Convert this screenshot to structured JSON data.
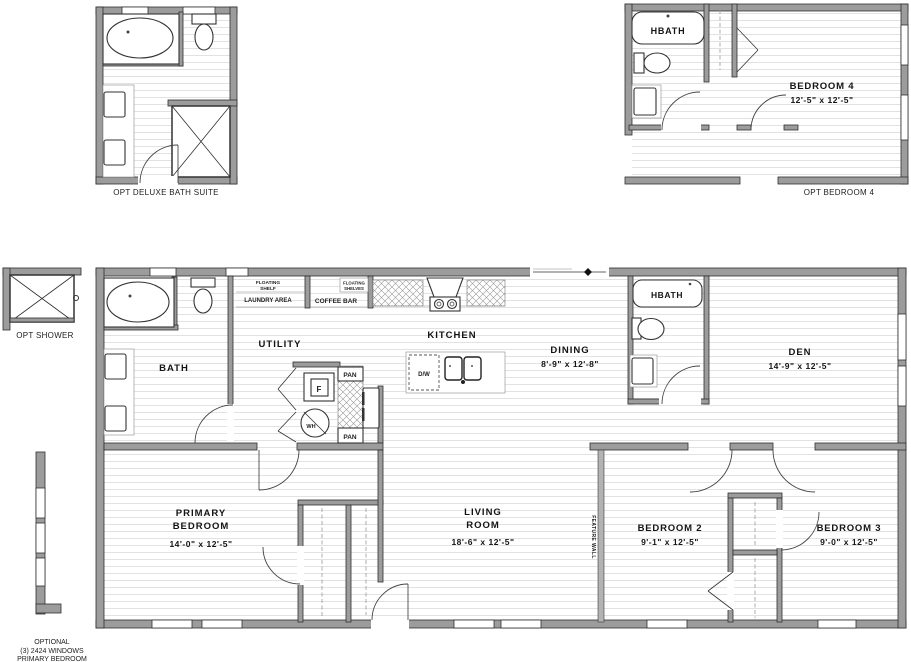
{
  "document_type": "floor-plan",
  "colors": {
    "wall_gray": "#9c9c9c",
    "feature_wall_gray": "#b3b3b3",
    "floor_line": "#e2e2e2",
    "fixture_stroke": "#333333"
  },
  "plans": {
    "deluxe_bath_suite": {
      "caption": "OPT DELUXE BATH SUITE"
    },
    "opt_bedroom_4": {
      "caption": "OPT BEDROOM 4",
      "hbath_label": "HBATH",
      "room_name": "BEDROOM 4",
      "room_dims": "12'-5\" x 12'-5\""
    },
    "opt_shower": {
      "caption": "OPT SHOWER"
    },
    "optional_windows": {
      "line1": "OPTIONAL",
      "line2": "(3) 2424 WINDOWS",
      "line3": "PRIMARY BEDROOM"
    },
    "main_floor": {
      "bath": {
        "name": "BATH"
      },
      "utility": {
        "name": "UTILITY",
        "floating_shelf_line1": "FLOATING",
        "floating_shelf_line2": "SHELF",
        "laundry_area": "LAUNDRY AREA",
        "freezer_label": "F",
        "water_heater_label": "WH",
        "pan_label": "PAN"
      },
      "coffee_bar": {
        "name": "COFFEE BAR",
        "floating_shelves_line1": "FLOATING",
        "floating_shelves_line2": "SHELVES"
      },
      "kitchen": {
        "name": "KITCHEN",
        "dishwasher_label": "D/W"
      },
      "dining": {
        "name": "DINING",
        "dims": "8'-9\" x 12'-8\""
      },
      "hbath": {
        "label": "HBATH"
      },
      "den": {
        "name": "DEN",
        "dims": "14'-9\" x 12'-5\""
      },
      "primary_bedroom": {
        "name_line1": "PRIMARY",
        "name_line2": "BEDROOM",
        "dims": "14'-0\" x 12'-5\""
      },
      "living_room": {
        "name_line1": "LIVING",
        "name_line2": "ROOM",
        "dims": "18'-6\" x 12'-5\""
      },
      "feature_wall": {
        "label": "FEATURE WALL"
      },
      "bedroom_2": {
        "name": "BEDROOM 2",
        "dims": "9'-1\" x 12'-5\""
      },
      "bedroom_3": {
        "name": "BEDROOM 3",
        "dims": "9'-0\" x 12'-5\""
      }
    }
  }
}
